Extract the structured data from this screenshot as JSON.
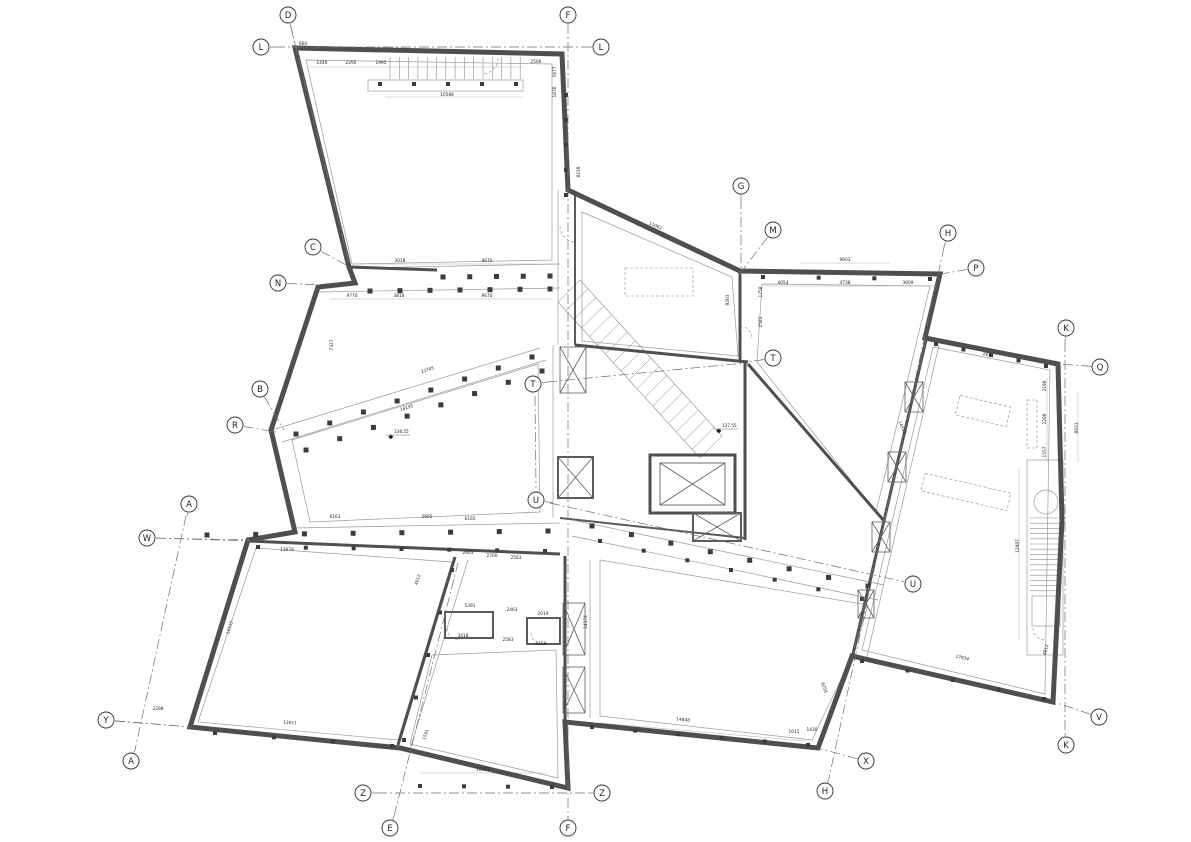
{
  "drawing": {
    "type": "architectural-floor-plan",
    "colors": {
      "wall": "#4f4f4f",
      "thin_line": "#9a9a9a",
      "axis_line": "#6f6f6f",
      "text": "#1f1f1f",
      "background": "#ffffff"
    },
    "grid_markers": [
      {
        "label": "D",
        "x": 288,
        "y": 15,
        "lx": 349,
        "ly": 263
      },
      {
        "label": "F",
        "x": 568,
        "y": 15,
        "lx": 568,
        "ly": 24
      },
      {
        "label": "L",
        "x": 261,
        "y": 47,
        "lx": 275,
        "ly": 47
      },
      {
        "label": "L",
        "x": 601,
        "y": 47,
        "lx": 588,
        "ly": 47
      },
      {
        "label": "C",
        "x": 313,
        "y": 247,
        "lx": 348,
        "ly": 266
      },
      {
        "label": "N",
        "x": 278,
        "y": 283,
        "lx": 320,
        "ly": 285
      },
      {
        "label": "G",
        "x": 741,
        "y": 186,
        "lx": 741,
        "ly": 199
      },
      {
        "label": "M",
        "x": 773,
        "y": 230,
        "lx": 742,
        "ly": 271
      },
      {
        "label": "H",
        "x": 948,
        "y": 233,
        "lx": 944,
        "ly": 247
      },
      {
        "label": "P",
        "x": 976,
        "y": 268,
        "lx": 941,
        "ly": 274
      },
      {
        "label": "K",
        "x": 1066,
        "y": 328,
        "lx": 1065,
        "ly": 342
      },
      {
        "label": "Q",
        "x": 1100,
        "y": 367,
        "lx": 1059,
        "ly": 364
      },
      {
        "label": "T",
        "x": 533,
        "y": 384,
        "lx": 547,
        "ly": 382
      },
      {
        "label": "T",
        "x": 773,
        "y": 358,
        "lx": 748,
        "ly": 362
      },
      {
        "label": "B",
        "x": 260,
        "y": 389,
        "lx": 284,
        "ly": 430
      },
      {
        "label": "R",
        "x": 235,
        "y": 425,
        "lx": 276,
        "ly": 432
      },
      {
        "label": "A",
        "x": 189,
        "y": 504,
        "lx": 187,
        "ly": 516
      },
      {
        "label": "U",
        "x": 536,
        "y": 500,
        "lx": 553,
        "ly": 503
      },
      {
        "label": "W",
        "x": 147,
        "y": 538,
        "lx": 250,
        "ly": 540
      },
      {
        "label": "U",
        "x": 913,
        "y": 584,
        "lx": 901,
        "ly": 581
      },
      {
        "label": "Y",
        "x": 106,
        "y": 720,
        "lx": 192,
        "ly": 727
      },
      {
        "label": "A",
        "x": 131,
        "y": 761,
        "lx": 135,
        "ly": 750
      },
      {
        "label": "Z",
        "x": 363,
        "y": 793,
        "lx": 377,
        "ly": 793
      },
      {
        "label": "E",
        "x": 390,
        "y": 828,
        "lx": 394,
        "ly": 816
      },
      {
        "label": "F",
        "x": 568,
        "y": 828,
        "lx": 568,
        "ly": 816
      },
      {
        "label": "Z",
        "x": 602,
        "y": 793,
        "lx": 588,
        "ly": 793
      },
      {
        "label": "X",
        "x": 866,
        "y": 761,
        "lx": 821,
        "ly": 749
      },
      {
        "label": "H",
        "x": 825,
        "y": 791,
        "lx": 829,
        "ly": 778
      },
      {
        "label": "K",
        "x": 1066,
        "y": 745,
        "lx": 1065,
        "ly": 733
      },
      {
        "label": "V",
        "x": 1099,
        "y": 717,
        "lx": 1057,
        "ly": 703
      }
    ],
    "axis_lines": [
      {
        "x1": 568,
        "y1": 24,
        "x2": 568,
        "y2": 816
      },
      {
        "x1": 275,
        "y1": 47,
        "x2": 588,
        "y2": 47
      },
      {
        "x1": 377,
        "y1": 793,
        "x2": 588,
        "y2": 793
      },
      {
        "x1": 1065,
        "y1": 342,
        "x2": 1065,
        "y2": 733
      },
      {
        "x1": 944,
        "y1": 247,
        "x2": 829,
        "y2": 778
      },
      {
        "x1": 186,
        "y1": 516,
        "x2": 135,
        "y2": 750
      },
      {
        "x1": 741,
        "y1": 199,
        "x2": 741,
        "y2": 275
      },
      {
        "x1": 394,
        "y1": 816,
        "x2": 458,
        "y2": 563
      },
      {
        "x1": 550,
        "y1": 503,
        "x2": 901,
        "y2": 581
      },
      {
        "x1": 547,
        "y1": 382,
        "x2": 745,
        "y2": 363
      },
      {
        "x1": 535,
        "y1": 396,
        "x2": 536,
        "y2": 488
      },
      {
        "x1": 156,
        "y1": 538,
        "x2": 250,
        "y2": 541
      },
      {
        "x1": 115,
        "y1": 721,
        "x2": 192,
        "y2": 727
      },
      {
        "x1": 291,
        "y1": 28,
        "x2": 349,
        "y2": 263
      },
      {
        "x1": 926,
        "y1": 340,
        "x2": 853,
        "y2": 654
      }
    ],
    "dimensions": [
      {
        "text": "600",
        "x": 303,
        "y": 45,
        "rot": 0
      },
      {
        "text": "1446",
        "x": 322,
        "y": 64,
        "rot": 0
      },
      {
        "text": "2290",
        "x": 351,
        "y": 64,
        "rot": 0
      },
      {
        "text": "1995",
        "x": 381,
        "y": 64,
        "rot": 0
      },
      {
        "text": "10586",
        "x": 447,
        "y": 96,
        "rot": 0
      },
      {
        "text": "2566",
        "x": 536,
        "y": 63,
        "rot": 0
      },
      {
        "text": "1677",
        "x": 556,
        "y": 72,
        "rot": -90
      },
      {
        "text": "1870",
        "x": 556,
        "y": 92,
        "rot": -90
      },
      {
        "text": "8239",
        "x": 580,
        "y": 172,
        "rot": -90
      },
      {
        "text": "3018",
        "x": 400,
        "y": 262,
        "rot": 0
      },
      {
        "text": "9670",
        "x": 487,
        "y": 262,
        "rot": 0
      },
      {
        "text": "9770",
        "x": 352,
        "y": 297,
        "rot": 0
      },
      {
        "text": "3818",
        "x": 399,
        "y": 297,
        "rot": 0
      },
      {
        "text": "9670",
        "x": 487,
        "y": 297,
        "rot": 0
      },
      {
        "text": "7327",
        "x": 333,
        "y": 345,
        "rot": -90
      },
      {
        "text": "11745",
        "x": 428,
        "y": 371,
        "rot": -17
      },
      {
        "text": "14195",
        "x": 407,
        "y": 409,
        "rot": -17
      },
      {
        "text": "11062",
        "x": 655,
        "y": 227,
        "rot": 24
      },
      {
        "text": "9203",
        "x": 729,
        "y": 300,
        "rot": -90
      },
      {
        "text": "1758",
        "x": 762,
        "y": 292,
        "rot": -90
      },
      {
        "text": "2583",
        "x": 762,
        "y": 322,
        "rot": -90
      },
      {
        "text": "9603",
        "x": 845,
        "y": 261,
        "rot": 0
      },
      {
        "text": "4054",
        "x": 783,
        "y": 284,
        "rot": 0
      },
      {
        "text": "4738",
        "x": 845,
        "y": 284,
        "rot": 0
      },
      {
        "text": "3609",
        "x": 908,
        "y": 284,
        "rot": 0
      },
      {
        "text": "14555",
        "x": 901,
        "y": 428,
        "rot": 65
      },
      {
        "text": "2651",
        "x": 988,
        "y": 356,
        "rot": 12
      },
      {
        "text": "2190",
        "x": 1046,
        "y": 386,
        "rot": -90
      },
      {
        "text": "2286",
        "x": 1046,
        "y": 419,
        "rot": -90
      },
      {
        "text": "1557",
        "x": 1046,
        "y": 452,
        "rot": -90
      },
      {
        "text": "8933",
        "x": 1078,
        "y": 428,
        "rot": -90
      },
      {
        "text": "12987",
        "x": 1019,
        "y": 546,
        "rot": -90
      },
      {
        "text": "17934",
        "x": 962,
        "y": 659,
        "rot": 13
      },
      {
        "text": "4812",
        "x": 1047,
        "y": 650,
        "rot": -75
      },
      {
        "text": "8259",
        "x": 823,
        "y": 688,
        "rot": 70
      },
      {
        "text": "1015",
        "x": 794,
        "y": 733,
        "rot": 0
      },
      {
        "text": "1430",
        "x": 812,
        "y": 731,
        "rot": 0
      },
      {
        "text": "14848",
        "x": 683,
        "y": 721,
        "rot": 5
      },
      {
        "text": "14374",
        "x": 587,
        "y": 622,
        "rot": -90
      },
      {
        "text": "6163",
        "x": 335,
        "y": 518,
        "rot": 0
      },
      {
        "text": "2665",
        "x": 427,
        "y": 518,
        "rot": 0
      },
      {
        "text": "6165",
        "x": 470,
        "y": 520,
        "rot": 0
      },
      {
        "text": "13078",
        "x": 287,
        "y": 551,
        "rot": 0
      },
      {
        "text": "2663",
        "x": 468,
        "y": 554,
        "rot": 0
      },
      {
        "text": "2700",
        "x": 492,
        "y": 557,
        "rot": 0
      },
      {
        "text": "2563",
        "x": 516,
        "y": 559,
        "rot": 0
      },
      {
        "text": "16535",
        "x": 231,
        "y": 628,
        "rot": -72
      },
      {
        "text": "2298",
        "x": 158,
        "y": 710,
        "rot": 0
      },
      {
        "text": "12611",
        "x": 290,
        "y": 724,
        "rot": 4
      },
      {
        "text": "5391",
        "x": 470,
        "y": 607,
        "rot": 0
      },
      {
        "text": "2463",
        "x": 512,
        "y": 611,
        "rot": 0
      },
      {
        "text": "2019",
        "x": 543,
        "y": 615,
        "rot": 0
      },
      {
        "text": "3418",
        "x": 463,
        "y": 637,
        "rot": 0
      },
      {
        "text": "2583",
        "x": 508,
        "y": 641,
        "rot": 0
      },
      {
        "text": "2150",
        "x": 541,
        "y": 645,
        "rot": 0
      },
      {
        "text": "10477",
        "x": 483,
        "y": 771,
        "rot": 0
      },
      {
        "text": "1591",
        "x": 427,
        "y": 735,
        "rot": -72
      },
      {
        "text": "4012",
        "x": 419,
        "y": 580,
        "rot": -72
      }
    ],
    "level_markers": [
      {
        "text": "138.55",
        "x": 396,
        "y": 434
      },
      {
        "text": "137.55",
        "x": 724,
        "y": 428
      }
    ]
  }
}
